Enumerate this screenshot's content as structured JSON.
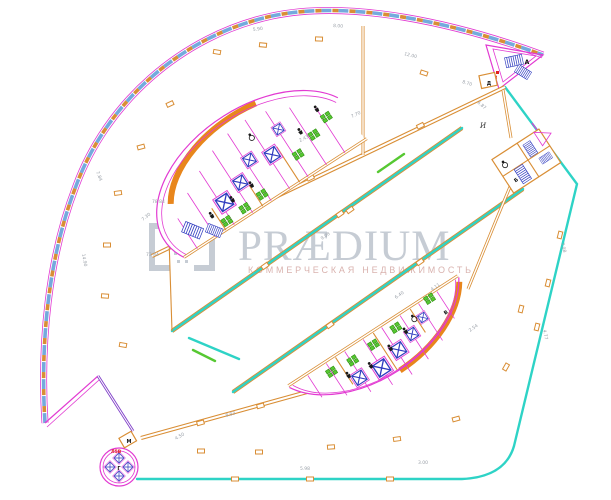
{
  "meta": {
    "type": "architectural floor plan (CAD)",
    "description": "Curved teardrop-shaped building floor plan with two elliptical service cores, central diagonal atrium, stair towers and watermark"
  },
  "watermark": {
    "title": "PRÆDIUM",
    "subtitle": "КОММЕРЧЕСКАЯ НЕДВИЖИМОСТЬ",
    "logo": "praedium-brackets-logo"
  },
  "labels": {
    "tip": "А",
    "tip_red": "А8",
    "mid_cluster": "Б",
    "lower_core": "В",
    "tower": "Г",
    "tower_red": "Л5В",
    "tower_room": "М",
    "upper_room": "Д",
    "field_mark": "И"
  },
  "dims": [
    "5.90",
    "8.00",
    "12.00",
    "8.70",
    "2.43",
    "7.70",
    "3.00",
    "7.98",
    "6.40",
    "4.77",
    "5.98",
    "7.84",
    "9.08",
    "14.90",
    "7.30",
    "4.11",
    "6.87",
    "2.54",
    "8.93",
    "4.50",
    "78 84",
    "73 84"
  ],
  "icons": [
    "stairs-icon",
    "elevator-shaft-icon",
    "wc-icon",
    "wheelchair-icon",
    "toilet-fixtures-icon",
    "column-icon"
  ],
  "colors": {
    "magenta": "#e23ad2",
    "orange": "#d98e35",
    "orangeFill": "#e8861c",
    "cyan": "#2ed3c6",
    "blue": "#2f3bbf",
    "lightblue": "#74aadd",
    "green": "#56c832",
    "greenDark": "#2f8f10",
    "purple": "#8040c8",
    "red": "#e02020",
    "dim": "#9aa0a8",
    "wm": "#c6ccd4",
    "wmSub": "#d9b2ae"
  }
}
